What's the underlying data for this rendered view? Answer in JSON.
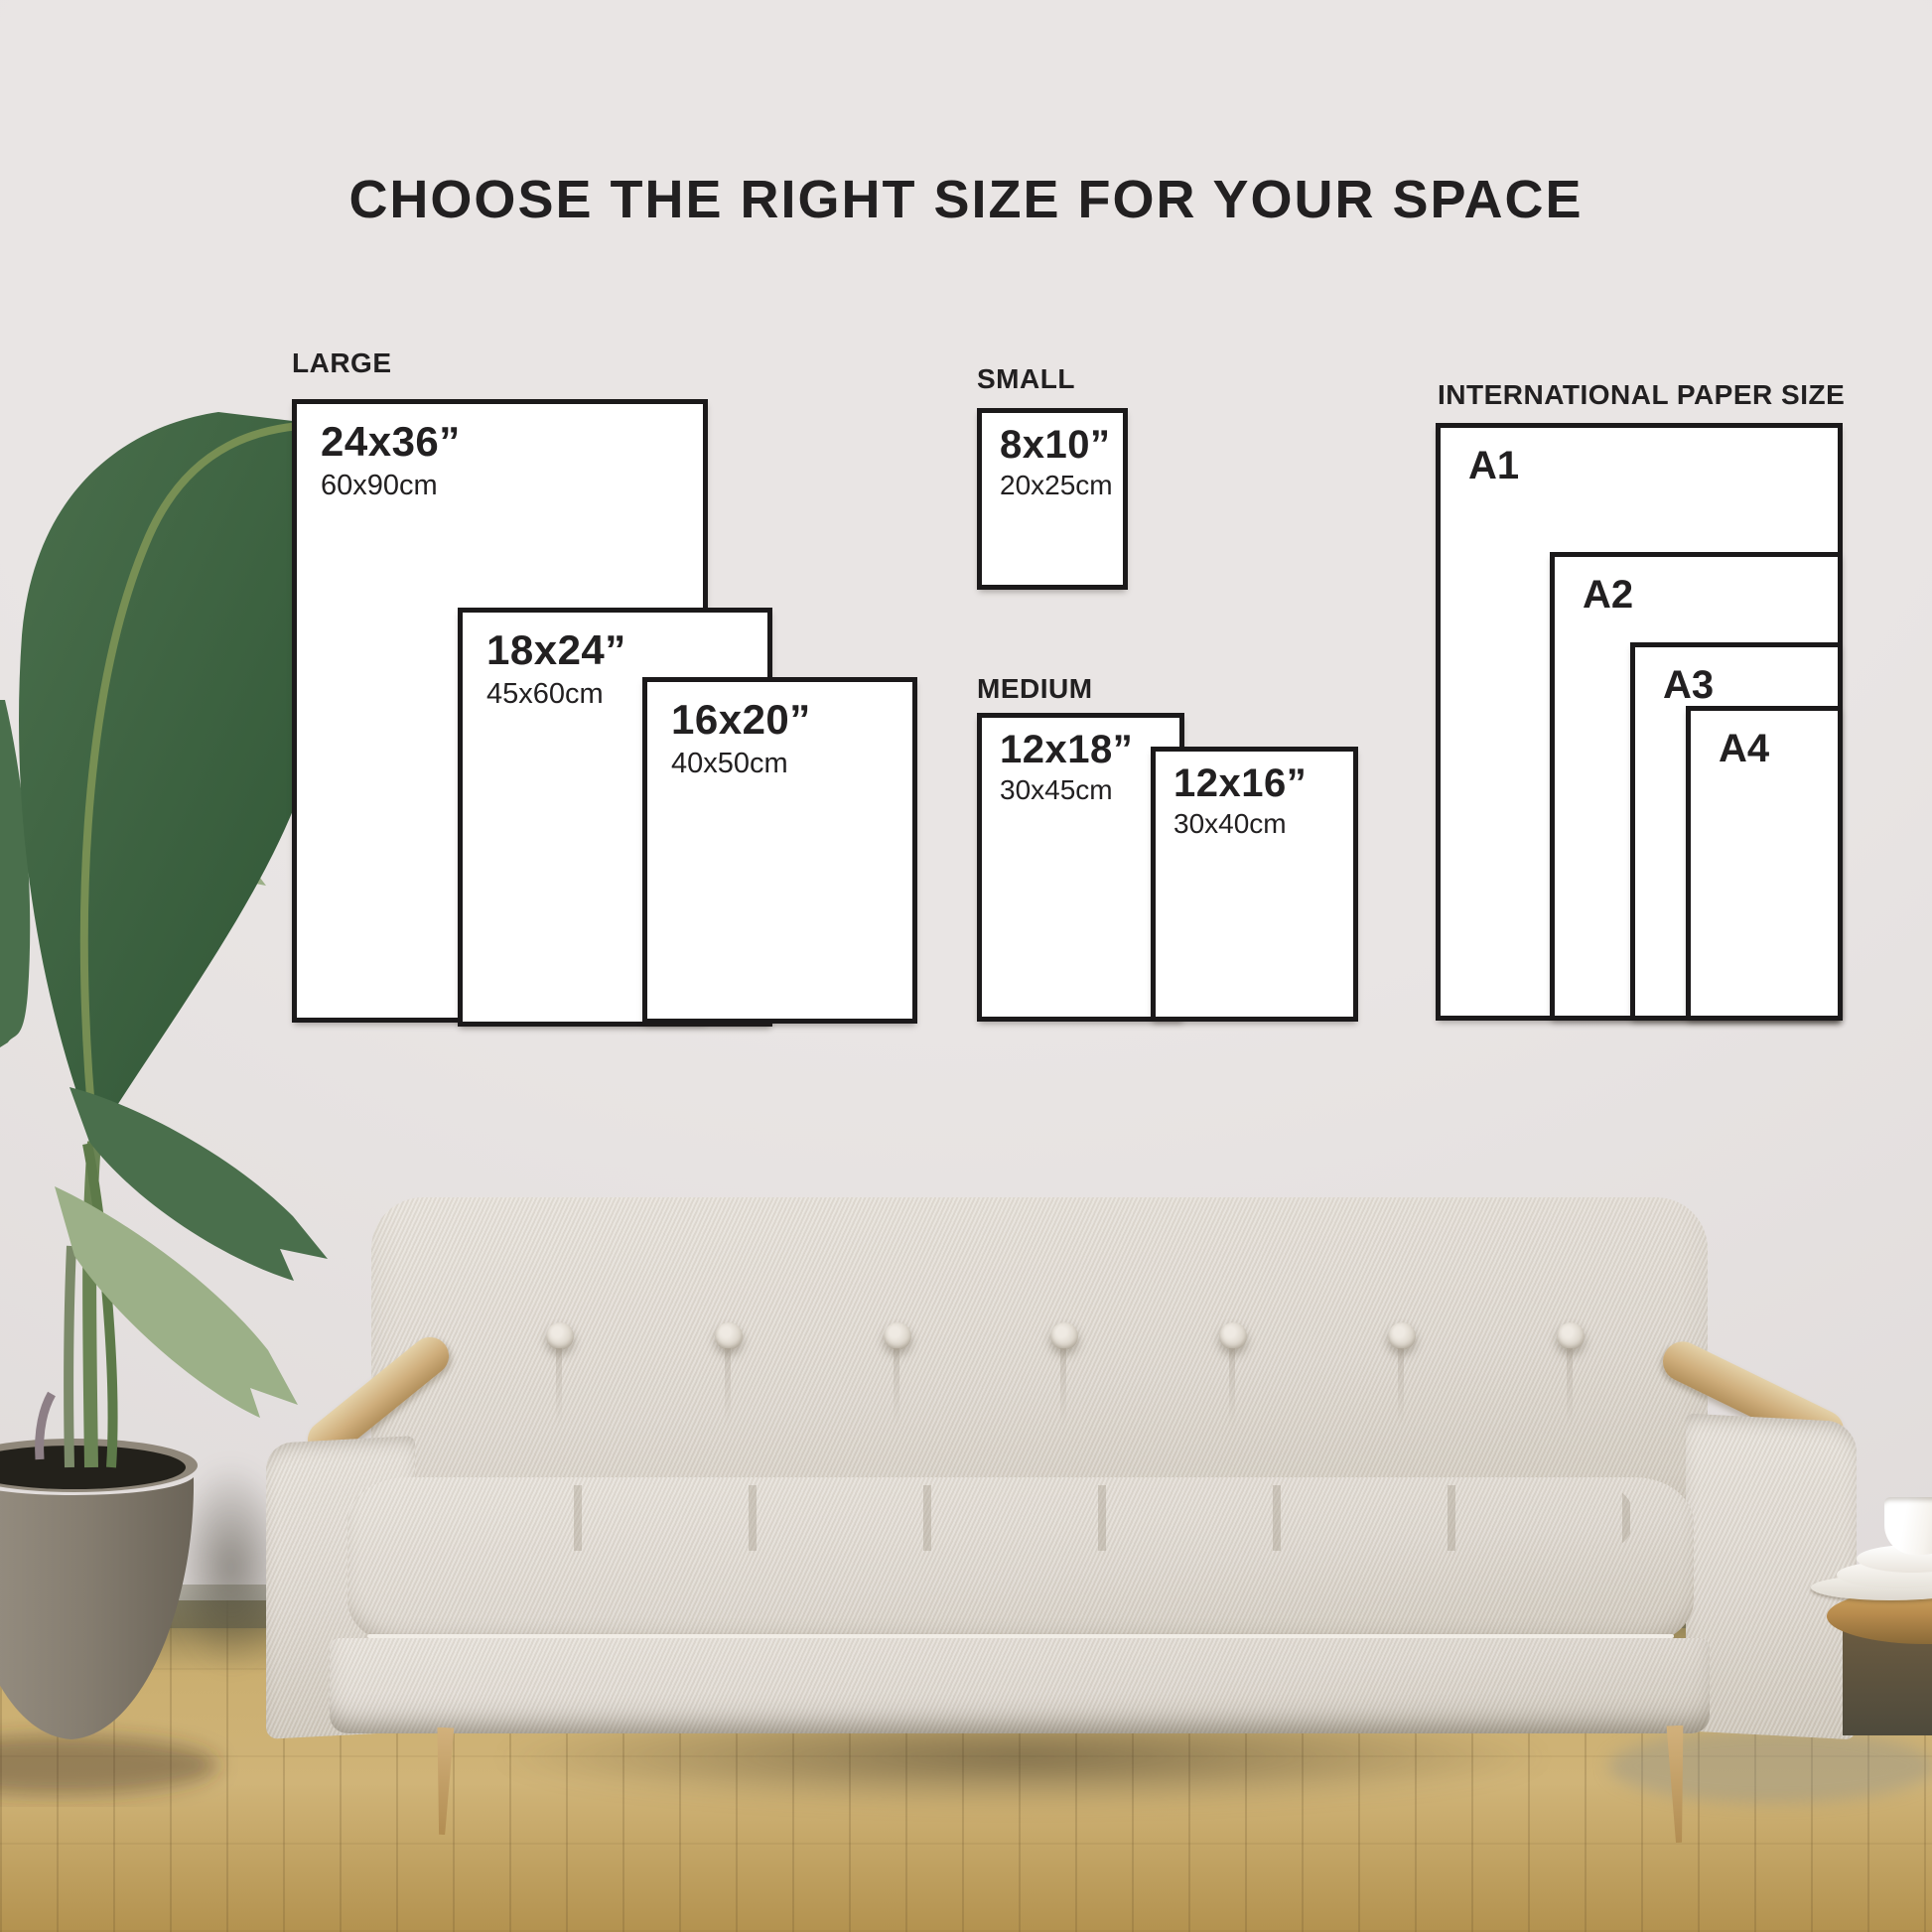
{
  "title": "CHOOSE THE RIGHT SIZE FOR YOUR SPACE",
  "groups": {
    "large": {
      "label": "LARGE",
      "sizes": [
        {
          "in": "24x36”",
          "cm": "60x90cm"
        },
        {
          "in": "18x24”",
          "cm": "45x60cm"
        },
        {
          "in": "16x20”",
          "cm": "40x50cm"
        }
      ]
    },
    "small": {
      "label": "SMALL",
      "sizes": [
        {
          "in": "8x10”",
          "cm": "20x25cm"
        }
      ]
    },
    "medium": {
      "label": "MEDIUM",
      "sizes": [
        {
          "in": "12x18”",
          "cm": "30x45cm"
        },
        {
          "in": "12x16”",
          "cm": "30x40cm"
        }
      ]
    },
    "international": {
      "label": "INTERNATIONAL PAPER SIZE",
      "sizes": [
        {
          "name": "A1"
        },
        {
          "name": "A2"
        },
        {
          "name": "A3"
        },
        {
          "name": "A4"
        }
      ]
    }
  },
  "scene": {
    "colors": {
      "wall": "#e9e5e4",
      "wall_shadow": "#dcd7d6",
      "floor": "#c9ad6e",
      "floor_dark": "#b3924f",
      "baseboard": "#5f5f4e",
      "box_border": "#1b191a",
      "box_fill": "#ffffff",
      "text": "#222021",
      "sofa": "#ded8d0",
      "sofa_dark": "#cfc8bc",
      "wood": "#cfae7c",
      "wood_dark": "#b2905c",
      "leaf_dark": "#2e5434",
      "leaf_mid": "#4a6f4c",
      "leaf_light": "#9cb088",
      "stem": "#6a8454",
      "pot_light": "#9a9285",
      "pot_dark": "#6b6458",
      "table_wood": "#b98c4e",
      "cup": "#f6f3ee"
    }
  }
}
